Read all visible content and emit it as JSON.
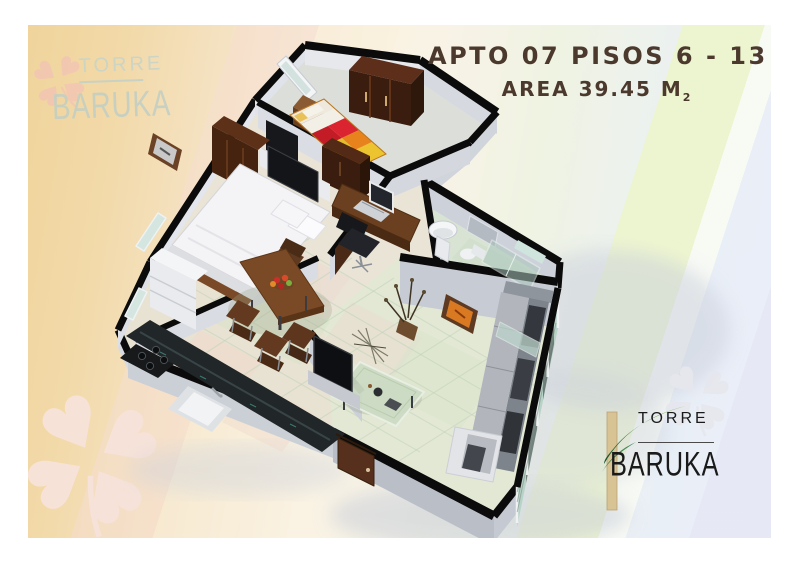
{
  "title": {
    "line1": "APTO 07 PISOS 6 - 13",
    "area_text": "AREA 39.45 M",
    "area_subscript": "2"
  },
  "brand": {
    "name_top": "TORRE",
    "name_bottom": "BARUKA"
  },
  "watermark": {
    "name_top": "TORRE",
    "name_bottom": "BARUKA"
  },
  "palette": {
    "title_text": "#4c392d",
    "logo_text": "#1a1a1a",
    "logo_leaf_dark": "#0f4f2c",
    "logo_leaf_light": "#7cc24a",
    "logo_bar": "#d8c394",
    "clover_pink": "#f2c4b4",
    "clover_pale": "#f7e3da",
    "clover_gray": "#e7e7ee",
    "wall_black": "#0b0b0b",
    "bg_left_tan": "#f0d49c",
    "bg_green_band": "#edf5d0",
    "bg_right_blue": "#e9eff7"
  }
}
